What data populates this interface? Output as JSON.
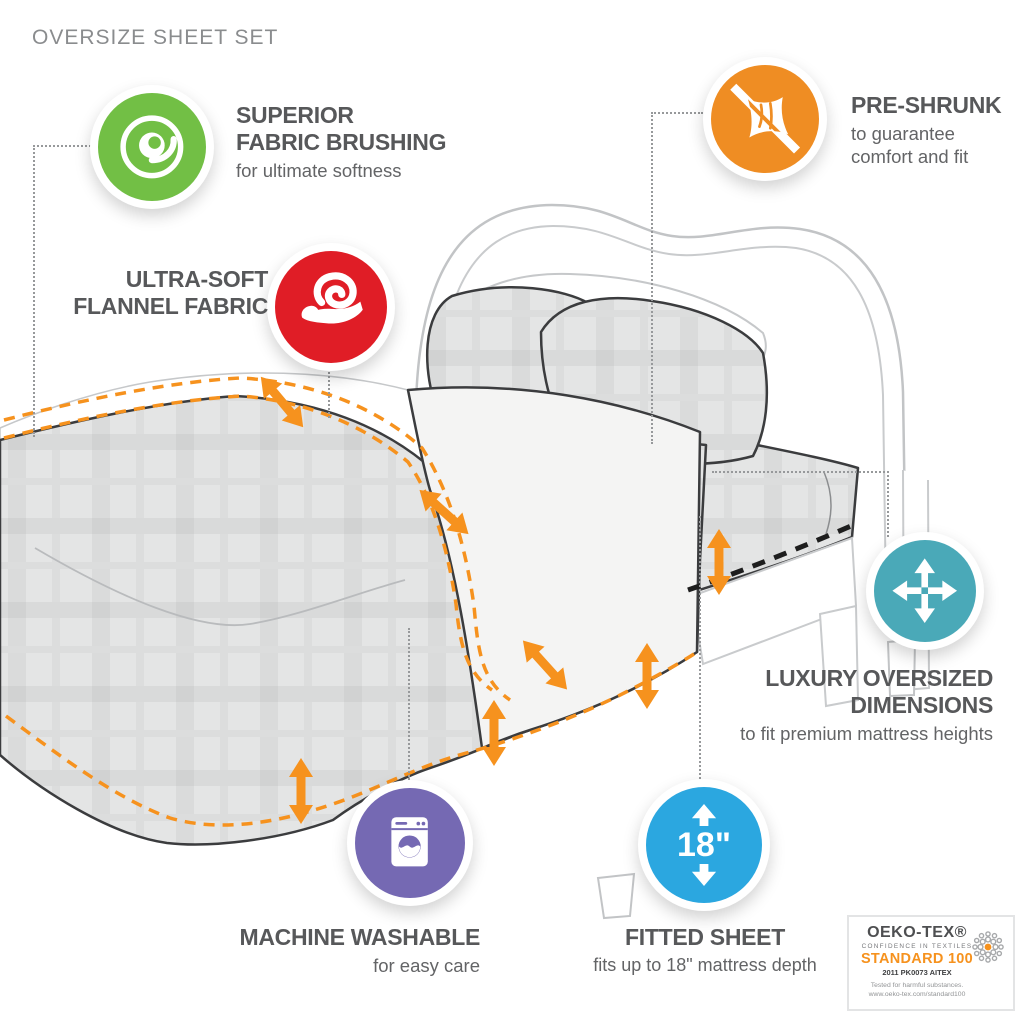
{
  "page": {
    "title": "OVERSIZE SHEET SET"
  },
  "features": [
    {
      "id": "superior-fabric-brushing",
      "icon": "swirl-icon",
      "color": "#72bf45",
      "title_lines": [
        "SUPERIOR",
        "FABRIC BRUSHING"
      ],
      "subtitle_lines": [
        "for ultimate softness"
      ]
    },
    {
      "id": "ultra-soft-flannel",
      "icon": "hand-fabric-icon",
      "color": "#e01d26",
      "title_lines": [
        "ULTRA-SOFT",
        "FLANNEL FABRIC"
      ],
      "subtitle_lines": []
    },
    {
      "id": "pre-shrunk",
      "icon": "no-shrink-icon",
      "color": "#ef8d23",
      "title_lines": [
        "PRE-SHRUNK"
      ],
      "subtitle_lines": [
        "to guarantee",
        "comfort and fit"
      ]
    },
    {
      "id": "luxury-oversized-dimensions",
      "icon": "expand-arrows-icon",
      "color": "#4aa9b8",
      "title_lines": [
        "LUXURY OVERSIZED",
        "DIMENSIONS"
      ],
      "subtitle_lines": [
        "to fit premium mattress heights"
      ]
    },
    {
      "id": "machine-washable",
      "icon": "washing-machine-icon",
      "color": "#7569b3",
      "title_lines": [
        "MACHINE WASHABLE"
      ],
      "subtitle_lines": [
        "for easy care"
      ]
    },
    {
      "id": "fitted-sheet",
      "icon": "depth-arrows-icon",
      "color": "#2ba7e0",
      "badge_text": "18\"",
      "title_lines": [
        "FITTED SHEET"
      ],
      "subtitle_lines": [
        "fits up to 18\" mattress depth"
      ]
    }
  ],
  "certification": {
    "brand": "OEKO-TEX®",
    "tagline": "CONFIDENCE IN TEXTILES",
    "standard": "STANDARD 100",
    "cert_number": "2011 PK0073 AITEX",
    "note": "Tested for harmful substances.",
    "url": "www.oeko-tex.com/standard100",
    "flower_icon": "oeko-flower-icon",
    "accent_color": "#f6921e"
  },
  "illustration": {
    "subject": "bed with oversize sheet set",
    "hem_marker_color": "#f6921e",
    "mattress_depth_marker_color": "#1e1e1e",
    "plaid_base_color": "#e4e5e5",
    "sheet_outline_color": "#3b3c3e",
    "frame_outline_color": "#c2c4c6",
    "text_gray": "#57585a"
  }
}
